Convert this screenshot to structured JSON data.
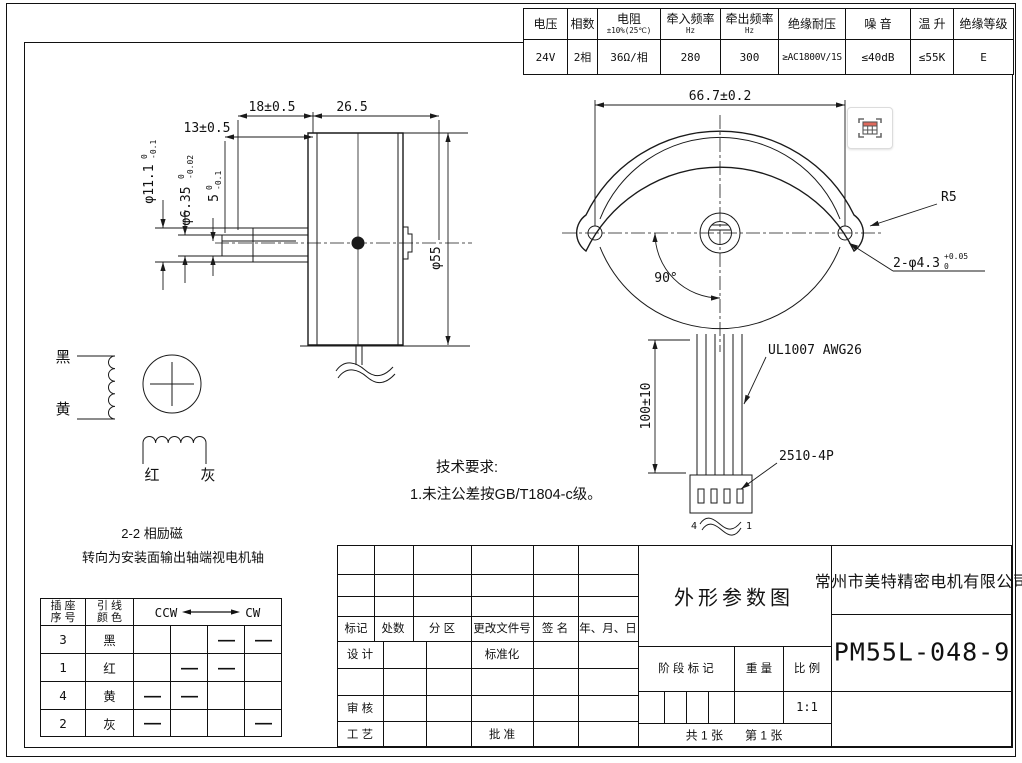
{
  "spec_table": {
    "headers": [
      {
        "l1": "电压",
        "l2": ""
      },
      {
        "l1": "相数",
        "l2": ""
      },
      {
        "l1": "电阻",
        "l2": "±10%(25℃)"
      },
      {
        "l1": "牵入频率",
        "l2": "Hz"
      },
      {
        "l1": "牵出频率",
        "l2": "Hz"
      },
      {
        "l1": "绝缘耐压",
        "l2": ""
      },
      {
        "l1": "噪 音",
        "l2": ""
      },
      {
        "l1": "温 升",
        "l2": ""
      },
      {
        "l1": "绝缘等级",
        "l2": ""
      }
    ],
    "values": [
      "24V",
      "2相",
      "36Ω/相",
      "280",
      "300",
      "≥AC1800V/1S",
      "≤40dB",
      "≤55K",
      "E"
    ]
  },
  "side_view": {
    "dim_13": "13±0.5",
    "dim_18": "18±0.5",
    "dim_26": "26.5",
    "dia_11": "φ11.1",
    "dia_11_tol_u": "0",
    "dia_11_tol_l": "-0.1",
    "dia_635": "φ6.35",
    "dia_635_tol_u": "0",
    "dia_635_tol_l": "-0.02",
    "dim_5": "5",
    "dim_5_tol_u": "0",
    "dim_5_tol_l": "-0.1",
    "dia_55": "φ55"
  },
  "front_view": {
    "dim_width": "66.7±0.2",
    "radius": "R5",
    "holes": "2-φ4.3",
    "holes_tol_u": "+0.05",
    "holes_tol_l": "0",
    "angle": "90°",
    "wire_length": "100±10",
    "wire_spec": "UL1007 AWG26",
    "connector": "2510-4P",
    "pin_left": "4",
    "pin_right": "1"
  },
  "phase_diagram": {
    "black": "黑",
    "yellow": "黄",
    "red": "红",
    "gray": "灰",
    "caption_excitation": "2-2 相励磁",
    "caption_direction": "转向为安装面输出轴端视电机轴"
  },
  "tech_req": {
    "title": "技术要求:",
    "item_1": "1.未注公差按GB/T1804-c级。"
  },
  "conn_table": {
    "header_col1_l1": "插 座",
    "header_col1_l2": "序 号",
    "header_col2_l1": "引 线",
    "header_col2_l2": "颜 色",
    "ccw": "CCW",
    "cw": "CW",
    "rows": [
      {
        "no": "3",
        "color": "黑",
        "steps": [
          "",
          "",
          "—",
          "—"
        ]
      },
      {
        "no": "1",
        "color": "红",
        "steps": [
          "",
          "—",
          "—",
          ""
        ]
      },
      {
        "no": "4",
        "color": "黄",
        "steps": [
          "—",
          "—",
          "",
          ""
        ]
      },
      {
        "no": "2",
        "color": "灰",
        "steps": [
          "—",
          "",
          "",
          "—"
        ]
      }
    ]
  },
  "title_block": {
    "rev_headers": [
      "标记",
      "处数",
      "分 区",
      "更改文件号",
      "签 名",
      "年、月、日"
    ],
    "design": "设 计",
    "standardization": "标准化",
    "audit": "审 核",
    "process": "工 艺",
    "approve": "批 准",
    "stage_mark": "阶 段 标 记",
    "weight": "重 量",
    "scale": "比 例",
    "scale_value": "1:1",
    "sheet_count": "共 1 张",
    "sheet_no": "第 1 张",
    "drawing_title": "外形参数图",
    "company": "常州市美特精密电机有限公司",
    "part_number": "PM55L-048-9"
  }
}
